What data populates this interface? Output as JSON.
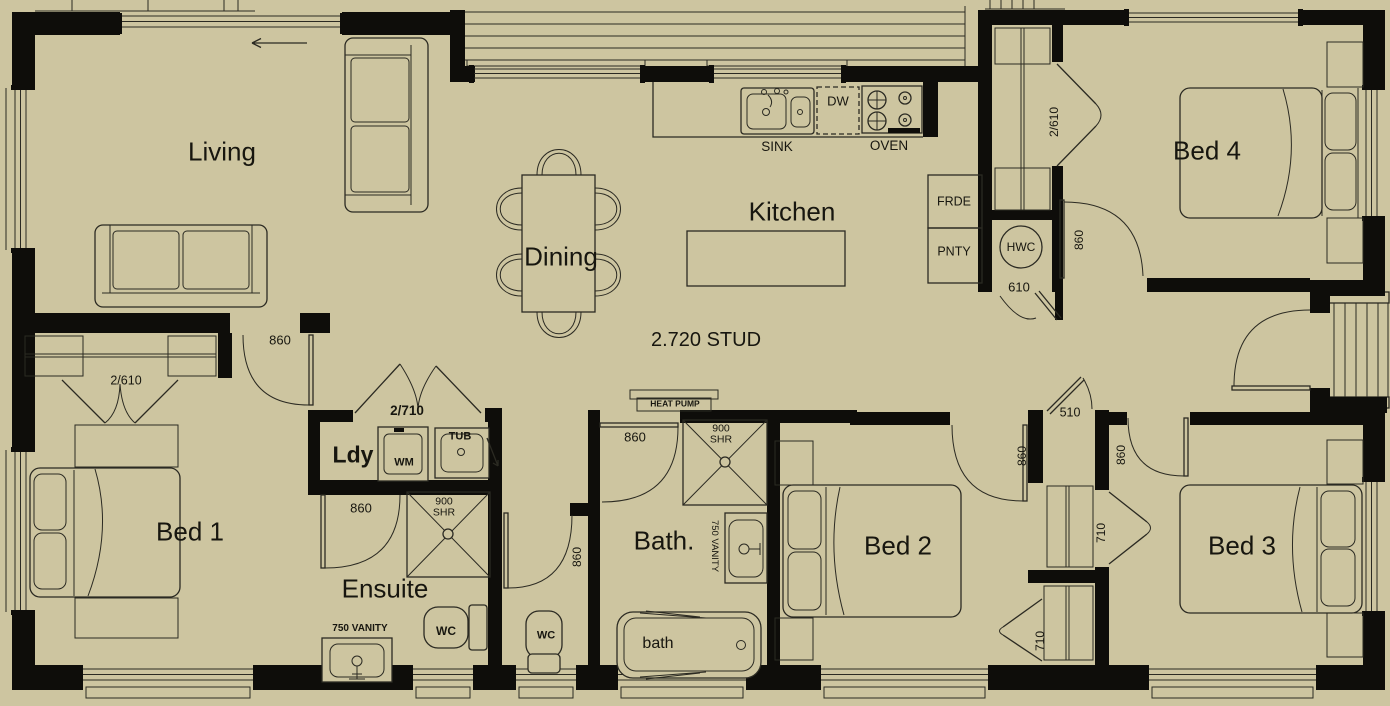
{
  "plan": {
    "rooms": {
      "living": "Living",
      "dining": "Dining",
      "kitchen": "Kitchen",
      "bed1": "Bed 1",
      "bed2": "Bed 2",
      "bed3": "Bed 3",
      "bed4": "Bed 4",
      "ensuite": "Ensuite",
      "bathroom": "Bath.",
      "laundry": "Ldy"
    },
    "fixtures": {
      "sink": "SINK",
      "dishwasher": "DW",
      "oven": "OVEN",
      "fridge": "FRDE",
      "pantry": "PNTY",
      "hot_water_cylinder": "HWC",
      "washing_machine": "WM",
      "laundry_tub": "TUB",
      "toilet_ensuite": "WC",
      "toilet_separate": "WC",
      "heat_pump": "HEAT PUMP",
      "bathtub": "bath"
    },
    "dimensions": {
      "stud_height": "2.720 STUD",
      "hwc_cupboard": "610",
      "linen_doors": "2/610",
      "bed1_wardrobe_doors": "2/610",
      "laundry_doors": "2/710",
      "hall_cupboard": "510",
      "bed2_wardrobe_door": "710",
      "bed3_wardrobe_door": "710",
      "shower_ensuite_width": "900",
      "shower_ensuite_abbr": "SHR",
      "shower_bath_width": "900",
      "shower_bath_abbr": "SHR",
      "vanity_ensuite": "750 VANITY",
      "vanity_bath": "750 VANITY",
      "door_bed1": "860",
      "door_bed2": "860",
      "door_bed3": "860",
      "door_bed4": "860",
      "door_ensuite": "860",
      "door_wc": "860",
      "door_bath": "860"
    },
    "icons": {
      "entry_arrow": "left-arrow"
    },
    "colors": {
      "background": "#cdc5a0",
      "walls": "#0e0d0a",
      "lines": "#2b2a22"
    }
  }
}
